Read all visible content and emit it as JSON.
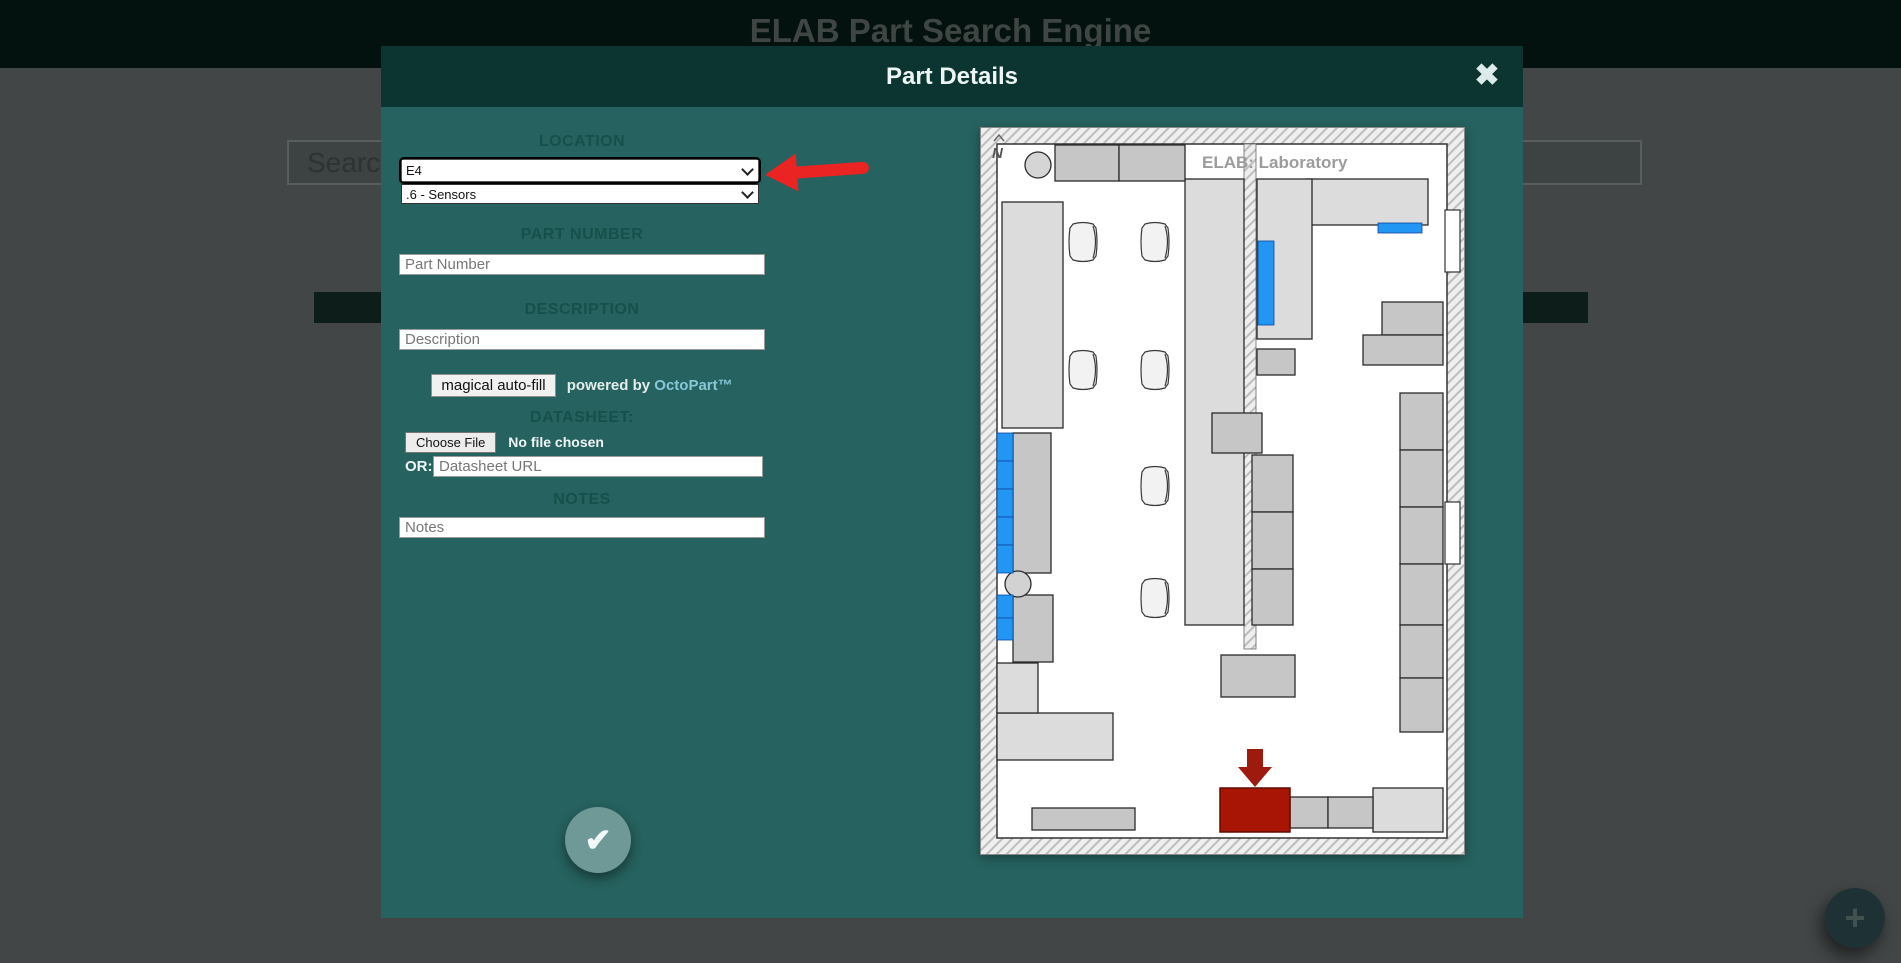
{
  "page": {
    "title": "ELAB Part Search Engine",
    "search": {
      "placeholder": "Search"
    },
    "add_part_icon": "+"
  },
  "modal": {
    "title": "Part Details",
    "close_icon": "✖",
    "form": {
      "location_label": "LOCATION",
      "location_area_value": "E4",
      "location_shelf_value": ".6 - Sensors",
      "part_number_label": "PART NUMBER",
      "part_number_placeholder": "Part Number",
      "description_label": "DESCRIPTION",
      "description_placeholder": "Description",
      "autofill_button": "magical auto-fill",
      "autofill_powered_by": "powered by",
      "autofill_brand": "OctoPart™",
      "datasheet_label": "DATASHEET:",
      "choose_file_button": "Choose File",
      "file_status": "No file chosen",
      "or_label": "OR:",
      "datasheet_url_placeholder": "Datasheet URL",
      "notes_label": "NOTES",
      "notes_placeholder": "Notes",
      "submit_icon": "✔"
    },
    "map": {
      "title": "ELAB: Laboratory",
      "compass": "N",
      "highlight_color": "#2196f3",
      "selected_color": "#a81505"
    }
  },
  "colors": {
    "modal_teal": "#26625f",
    "modal_header_teal": "#0c3430",
    "annotation_red": "#ea2323",
    "octopart_blue": "#86c8da"
  }
}
